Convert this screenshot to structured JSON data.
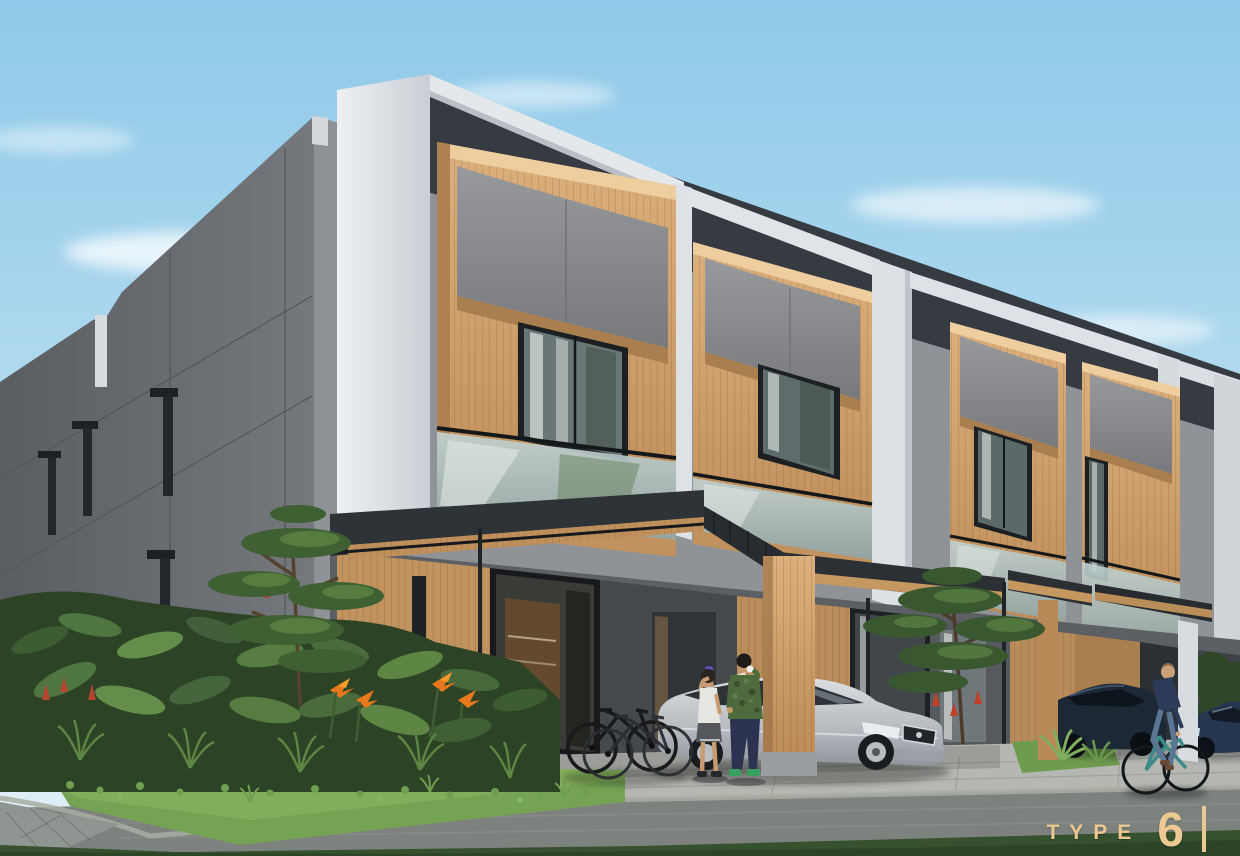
{
  "label": {
    "prefix": "TYPE",
    "number": "6",
    "divider": "|"
  },
  "palette": {
    "accent": "#ecc992",
    "sky_top": "#8ec9e9",
    "sky_bottom": "#ddeef6",
    "wood": "#cfa571",
    "wood_lit": "#eecd9e",
    "panel_grey": "#8d9094",
    "wall_side": "#63666a",
    "wall_front": "#8f9296",
    "charcoal": "#363b42",
    "white_structure": "#e6e9ec",
    "foliage_dark": "#2c4325",
    "foliage": "#4f7540",
    "lawn": "#76a253",
    "road": "#7d827f",
    "flower_orange": "#e8781c",
    "flower_red": "#b8432f",
    "bike_teal": "#3d8a86",
    "car_silver": "#c6cbd0",
    "car_navy": "#1c2836",
    "car_blue": "#243650"
  },
  "scene": {
    "type": "architectural-exterior-render",
    "subject": "modern two-storey townhouse row with carports",
    "units_visible": 4,
    "people": 3,
    "cars": 3,
    "bicycles": 3
  }
}
